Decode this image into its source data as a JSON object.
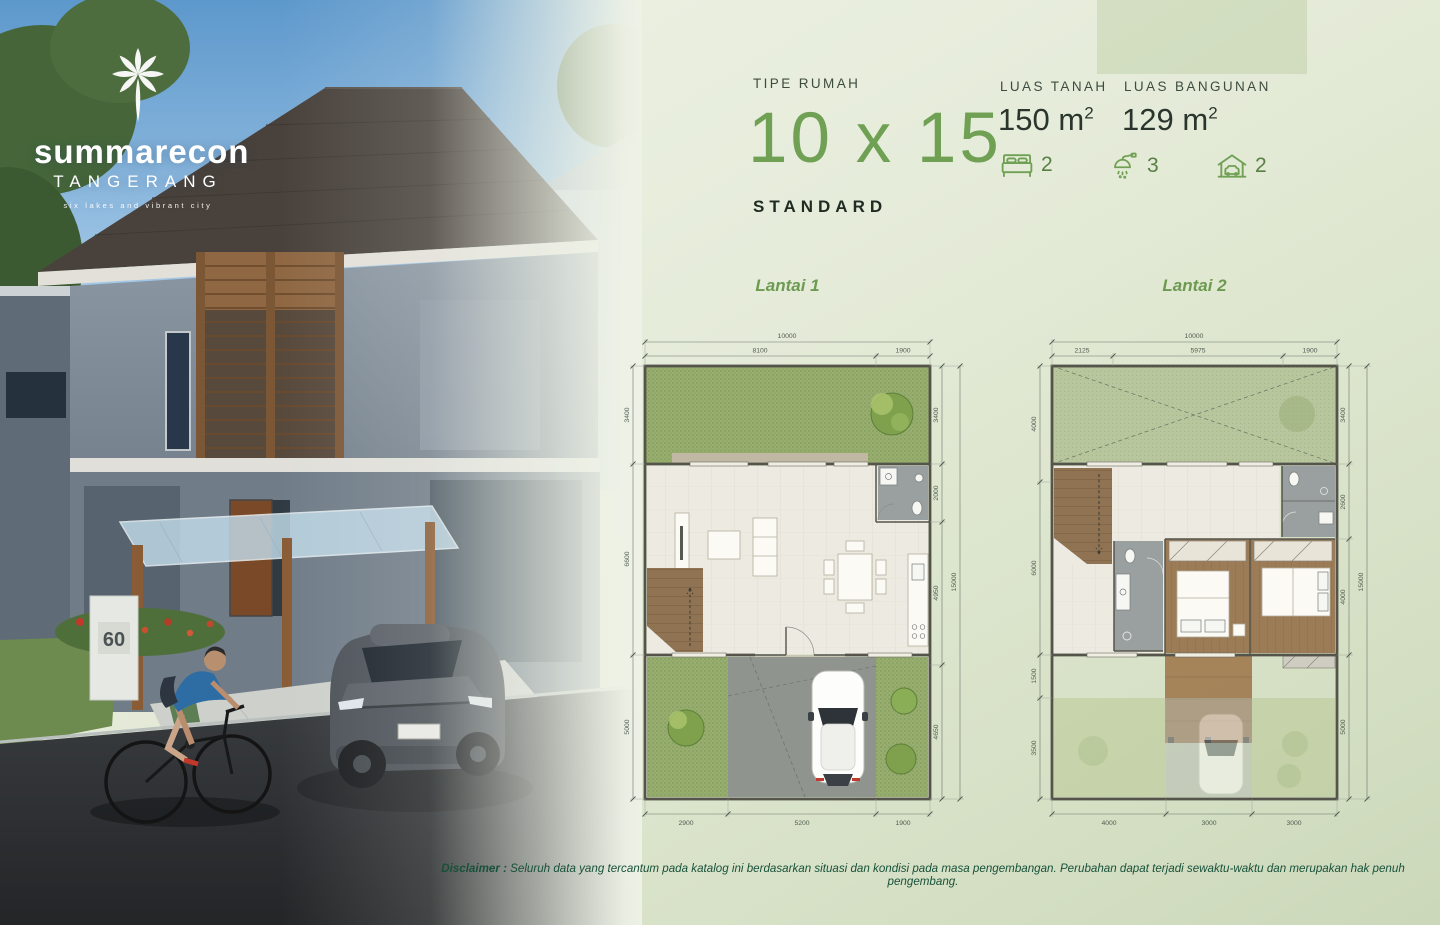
{
  "logo": {
    "brand": "summarecon",
    "city": "TANGERANG",
    "tagline": "six lakes and vibrant city"
  },
  "photo": {
    "house_number": "60"
  },
  "spec": {
    "type_label": "TIPE RUMAH",
    "type_value": "10 x 15",
    "variant": "STANDARD",
    "land_label": "LUAS TANAH",
    "land_value": "150",
    "land_unit": "m",
    "land_sup": "2",
    "building_label": "LUAS BANGUNAN",
    "building_value": "129",
    "building_unit": "m",
    "building_sup": "2",
    "bedrooms": "2",
    "bathrooms": "3",
    "carports": "2"
  },
  "plans": {
    "lantai1": {
      "title": "Lantai 1",
      "total_width": "10000",
      "total_height": "15000",
      "top": [
        "8100",
        "1900"
      ],
      "bottom": [
        "2900",
        "5200",
        "1900"
      ],
      "left": [
        "3400",
        "6600",
        "5000"
      ],
      "right": [
        "3400",
        "2000",
        "4950",
        "4650"
      ]
    },
    "lantai2": {
      "title": "Lantai 2",
      "total_width": "10000",
      "total_height": "15000",
      "top": [
        "2125",
        "5975",
        "1900"
      ],
      "bottom": [
        "4000",
        "3000",
        "3000"
      ],
      "left": [
        "4000",
        "6000",
        "1500",
        "3500"
      ],
      "right": [
        "3400",
        "2600",
        "4000",
        "5000"
      ]
    }
  },
  "disclaimer": {
    "label": "Disclaimer :",
    "text": "Seluruh data yang tercantum pada katalog ini berdasarkan situasi dan kondisi pada masa pengembangan. Perubahan dapat terjadi sewaktu-waktu dan merupakan hak penuh pengembang."
  },
  "colors": {
    "accent_green": "#6fa054",
    "dark_text": "#202b23",
    "disclaimer_green": "#17513a"
  }
}
